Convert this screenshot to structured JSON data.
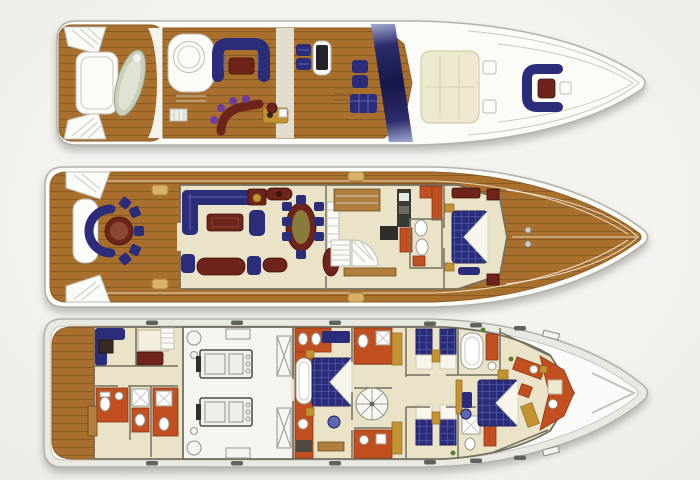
{
  "image": {
    "width": 700,
    "height": 480,
    "background": "#f2f1ed"
  },
  "colors": {
    "hull": "#fbfbf7",
    "hull_edge": "#b2b2aa",
    "band": "#e9e9e2",
    "teak": "#a9702d",
    "teak_dark": "#8a5a22",
    "cream": "#ebe3c8",
    "wall": "#73705f",
    "navy": "#2b2d7b",
    "navy_light": "#5c66b2",
    "maroon": "#6e241a",
    "red": "#c24f1f",
    "gold": "#c59232",
    "wood": "#b07f3e",
    "purple": "#6f3da0",
    "tender": "#c9cfbc",
    "engine_floor": "#f4f4f0",
    "arch_dark": "#16174a",
    "arch_mid": "#2c2d6b",
    "arch_light": "#9aa2cc"
  },
  "decks": [
    {
      "id": "flybridge-deck",
      "order": 1
    },
    {
      "id": "main-deck",
      "order": 2
    },
    {
      "id": "lower-deck",
      "order": 3
    }
  ]
}
